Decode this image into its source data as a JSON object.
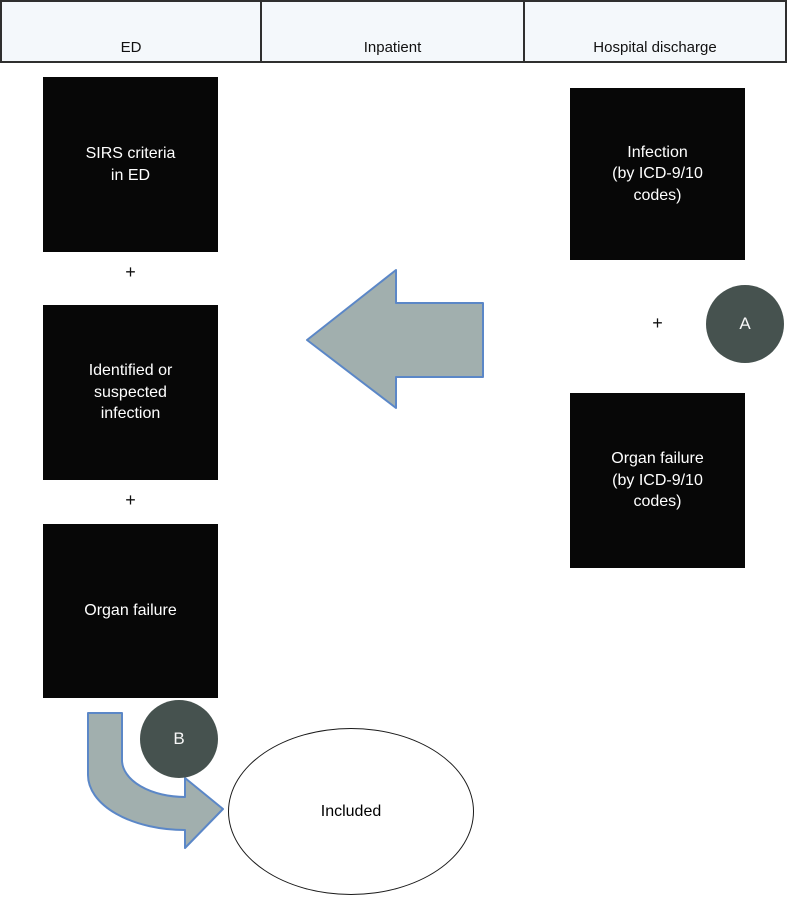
{
  "palette": {
    "arrow_fill": "#a1afae",
    "arrow_stroke": "#5b87c7",
    "box_bg": "#070707",
    "box_text": "#ffffff",
    "circle_bg": "#46524f",
    "header_bg": "#f4f8fb",
    "header_border": "#2f2f2f"
  },
  "header": {
    "columns": [
      {
        "label": "ED"
      },
      {
        "label": "Inpatient"
      },
      {
        "label": "Hospital discharge"
      }
    ]
  },
  "ed_column": {
    "box_sirs": "SIRS criteria\nin ED",
    "plus_1": "+",
    "box_infection": "Identified or\nsuspected\ninfection",
    "plus_2": "+",
    "box_organ_failure": "Organ failure"
  },
  "discharge_column": {
    "box_infection_icd": "Infection\n(by ICD-9/10\ncodes)",
    "plus": "+",
    "box_organ_failure_icd": "Organ failure\n(by ICD-9/10\ncodes)",
    "marker_a": "A"
  },
  "flow": {
    "marker_b": "B",
    "included_label": "Included"
  }
}
